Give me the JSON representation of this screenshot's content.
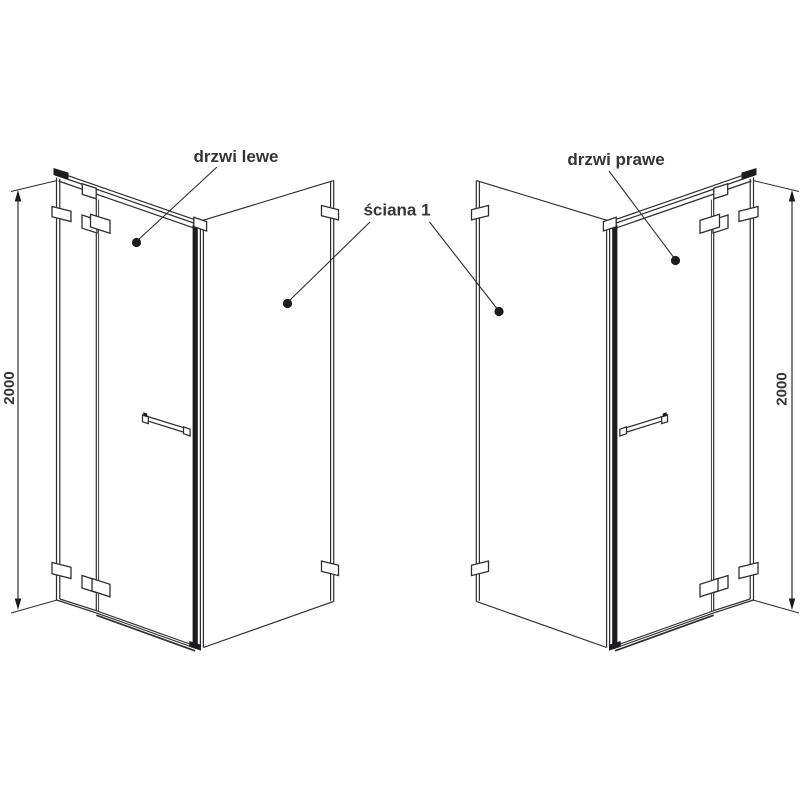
{
  "diagram": {
    "labels": {
      "left_door": "drzwi lewe",
      "right_door": "drzwi prawe",
      "wall": "ściana 1"
    },
    "dimensions": {
      "left_height": "2000",
      "right_height": "2000"
    },
    "colors": {
      "line": "#2e2e30",
      "text": "#353537",
      "background": "#ffffff"
    }
  }
}
